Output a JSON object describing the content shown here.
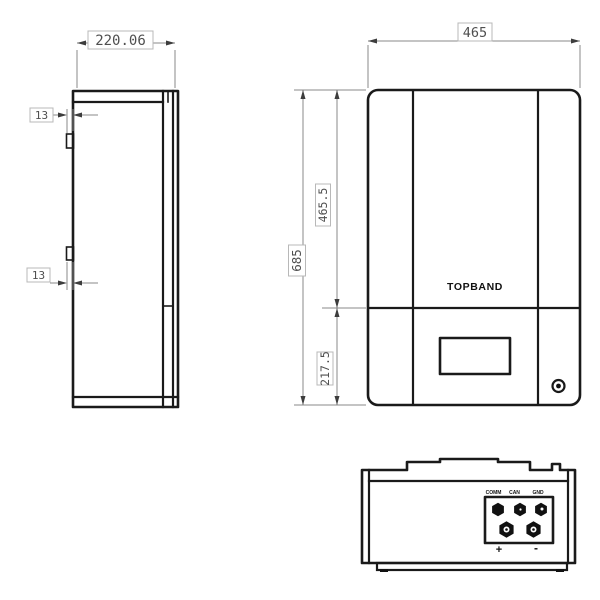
{
  "drawing": {
    "brand_logo": "TOPBAND",
    "views": {
      "side": {
        "label": "side-view",
        "depth_dim": "220.06",
        "hook_offset_top": "13",
        "hook_offset_bottom": "13"
      },
      "front": {
        "label": "front-view",
        "width_dim": "465",
        "height_dim": "685",
        "upper_section_dim": "465.5",
        "lower_section_dim": "217.5",
        "logo": "TOPBAND"
      },
      "bottom": {
        "label": "bottom-view",
        "terminal_labels": [
          "COMM",
          "CAN",
          "GND"
        ],
        "polarity_positive": "+",
        "polarity_negative": "-"
      }
    },
    "colors": {
      "object_line": "#1a1a1a",
      "dimension_line": "#8a8a8a",
      "dimension_text": "#4f4f4f",
      "dimension_box_border": "#b8b8b8",
      "background": "#ffffff"
    }
  }
}
